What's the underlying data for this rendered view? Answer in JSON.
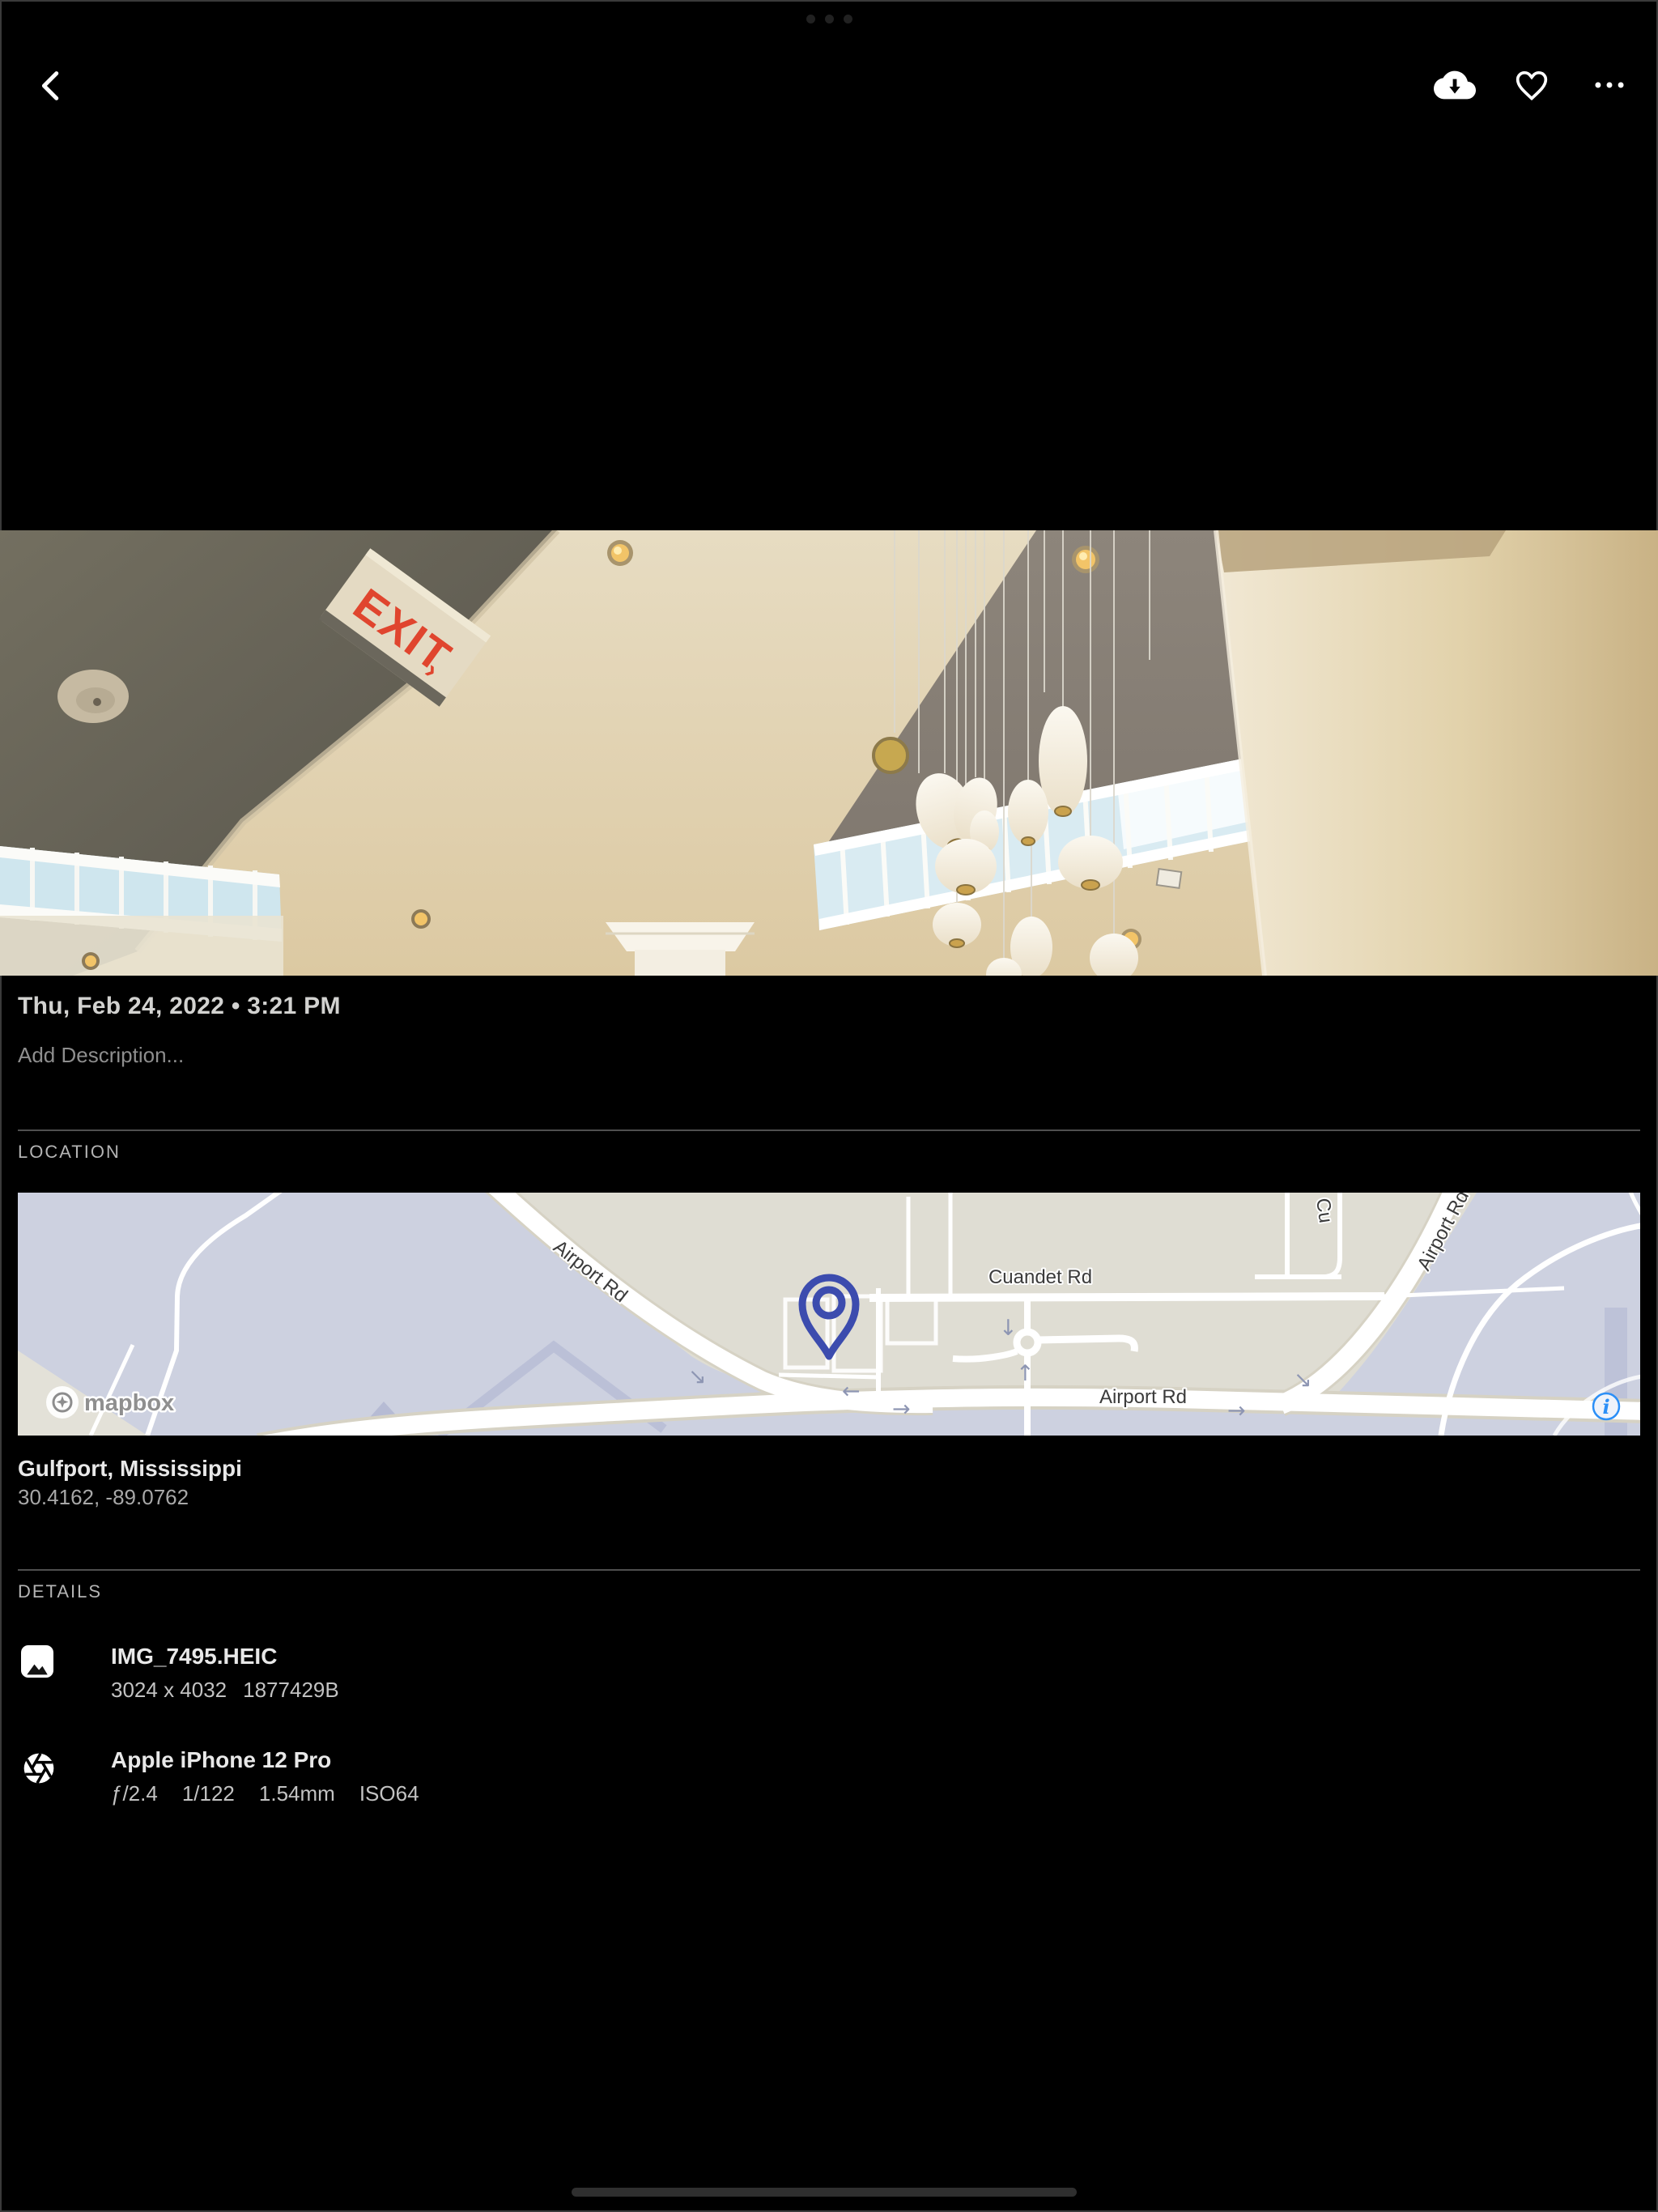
{
  "toolbar": {
    "back_icon": "chevron-left",
    "download_icon": "cloud-download",
    "favorite_icon": "heart-outline",
    "more_icon": "ellipsis"
  },
  "photo": {
    "exit_sign": "EXIT",
    "exit_sign_arrow": "›"
  },
  "info": {
    "date": "Thu, Feb 24, 2022 • 3:21 PM",
    "description_placeholder": "Add Description...",
    "location": {
      "header": "LOCATION",
      "place": "Gulfport, Mississippi",
      "coordinates": "30.4162, -89.0762",
      "map": {
        "attribution": "mapbox",
        "labels": {
          "airport_rd_diag": "Airport Rd",
          "cuandet_rd": "Cuandet Rd",
          "airport_rd_horiz": "Airport Rd",
          "airport_rd_upper": "Airport Rd",
          "partial_road": "Cu"
        }
      }
    },
    "details": {
      "header": "DETAILS",
      "file": {
        "name": "IMG_7495.HEIC",
        "dimensions": "3024 x 4032",
        "size": "1877429B"
      },
      "camera": {
        "name": "Apple iPhone 12 Pro",
        "aperture": "ƒ/2.4",
        "shutter": "1/122",
        "focal_length": "1.54mm",
        "iso": "ISO64"
      }
    }
  },
  "colors": {
    "pin_blue": "#3c4cae",
    "info_blue": "#2b8ff7",
    "exit_red": "#e0452e",
    "map_land": "#dfddd3",
    "map_base": "#cdd1e0"
  }
}
